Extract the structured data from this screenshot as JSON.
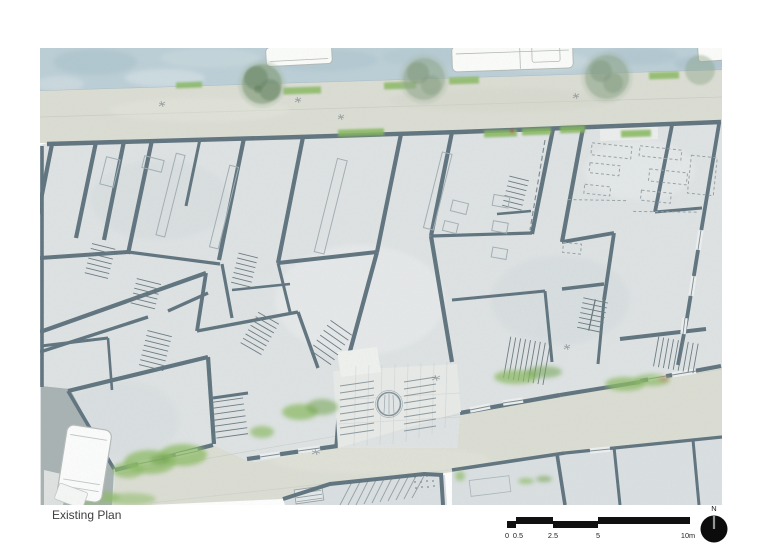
{
  "page": {
    "title": "Existing Plan"
  },
  "scale_bar": {
    "tick_labels": [
      "0",
      "0.5",
      "2.5",
      "5"
    ],
    "end_label": "10m"
  },
  "north_arrow": {
    "label": "N"
  },
  "palette": {
    "water": "#bccfd7",
    "pavement": "#dcded4",
    "building_floor": "#dfe3e4",
    "wall": "#5f737e",
    "vegetation": "#8cbb64",
    "tree": "#7d9a74",
    "scale_bar": "#101010",
    "title_text": "#3e3e3e"
  }
}
